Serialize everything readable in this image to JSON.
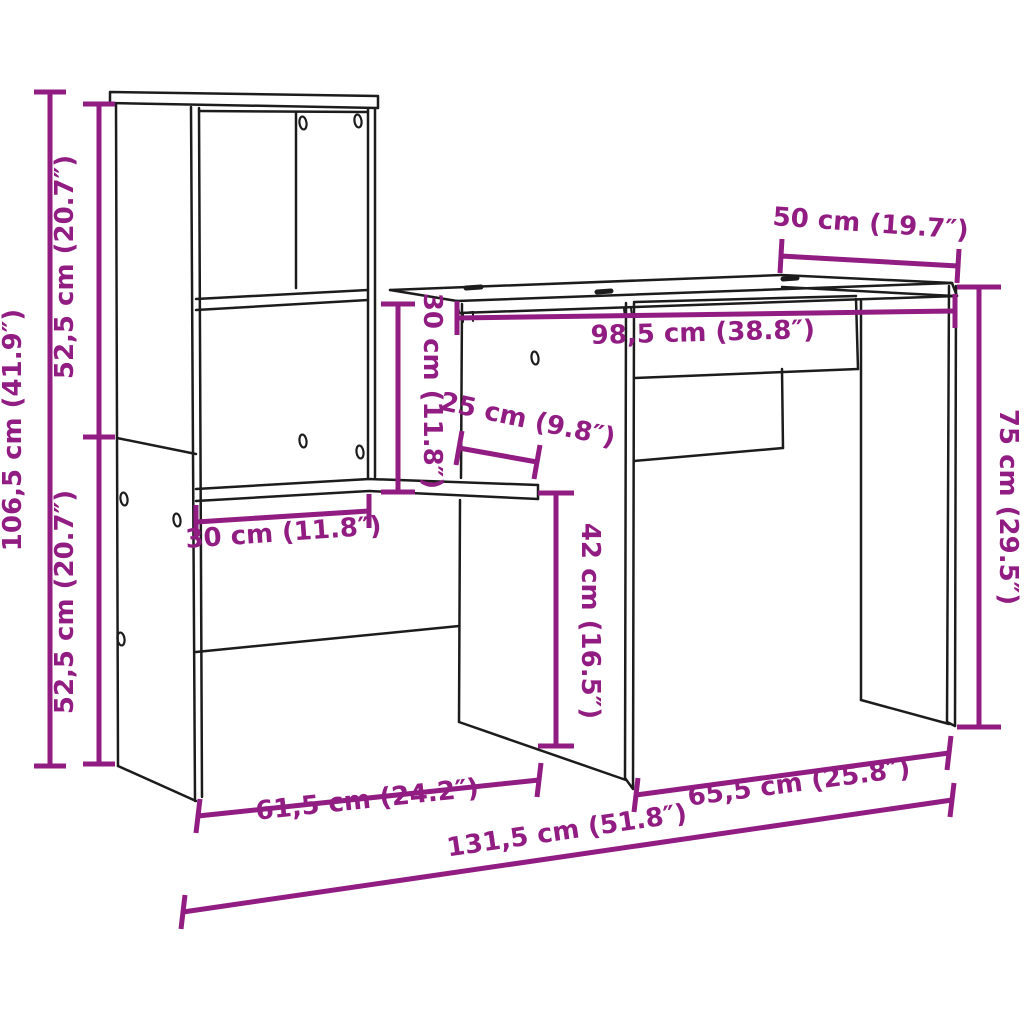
{
  "diagram": {
    "kind": "furniture-dimension-drawing",
    "subject": "desk-with-shelf-unit",
    "colors": {
      "dimension": "#911c82",
      "outline": "#1c1c1c",
      "background": "#ffffff"
    },
    "dimensions": [
      {
        "id": "total-height",
        "value_cm": "106,5",
        "value_in": "41.9",
        "label": "106,5 cm (41.9″)"
      },
      {
        "id": "upper-section-height",
        "value_cm": "52,5",
        "value_in": "20.7",
        "label": "52,5 cm (20.7″)"
      },
      {
        "id": "lower-section-height",
        "value_cm": "52,5",
        "value_in": "20.7",
        "label": "52,5 cm (20.7″)"
      },
      {
        "id": "desk-depth",
        "value_cm": "50",
        "value_in": "19.7",
        "label": "50 cm (19.7″)"
      },
      {
        "id": "desktop-width",
        "value_cm": "98,5",
        "value_in": "38.8",
        "label": "98,5 cm (38.8″)"
      },
      {
        "id": "clearance-height",
        "value_cm": "30",
        "value_in": "11.8",
        "label": "30 cm (11.8″)"
      },
      {
        "id": "shelf-depth",
        "value_cm": "25",
        "value_in": "9.8",
        "label": "25 cm (9.8″)"
      },
      {
        "id": "shelf-width",
        "value_cm": "30",
        "value_in": "11.8",
        "label": "30 cm (11.8″)"
      },
      {
        "id": "under-shelf-height",
        "value_cm": "42",
        "value_in": "16.5",
        "label": "42 cm (16.5″)"
      },
      {
        "id": "desk-height",
        "value_cm": "75",
        "value_in": "29.5",
        "label": "75 cm (29.5″)"
      },
      {
        "id": "shelf-unit-width",
        "value_cm": "61,5",
        "value_in": "24.2",
        "label": "61,5 cm (24.2″)"
      },
      {
        "id": "desk-width",
        "value_cm": "65,5",
        "value_in": "25.8",
        "label": "65,5 cm (25.8″)"
      },
      {
        "id": "total-width",
        "value_cm": "131,5",
        "value_in": "51.8",
        "label": "131,5 cm (51.8″)"
      }
    ]
  }
}
